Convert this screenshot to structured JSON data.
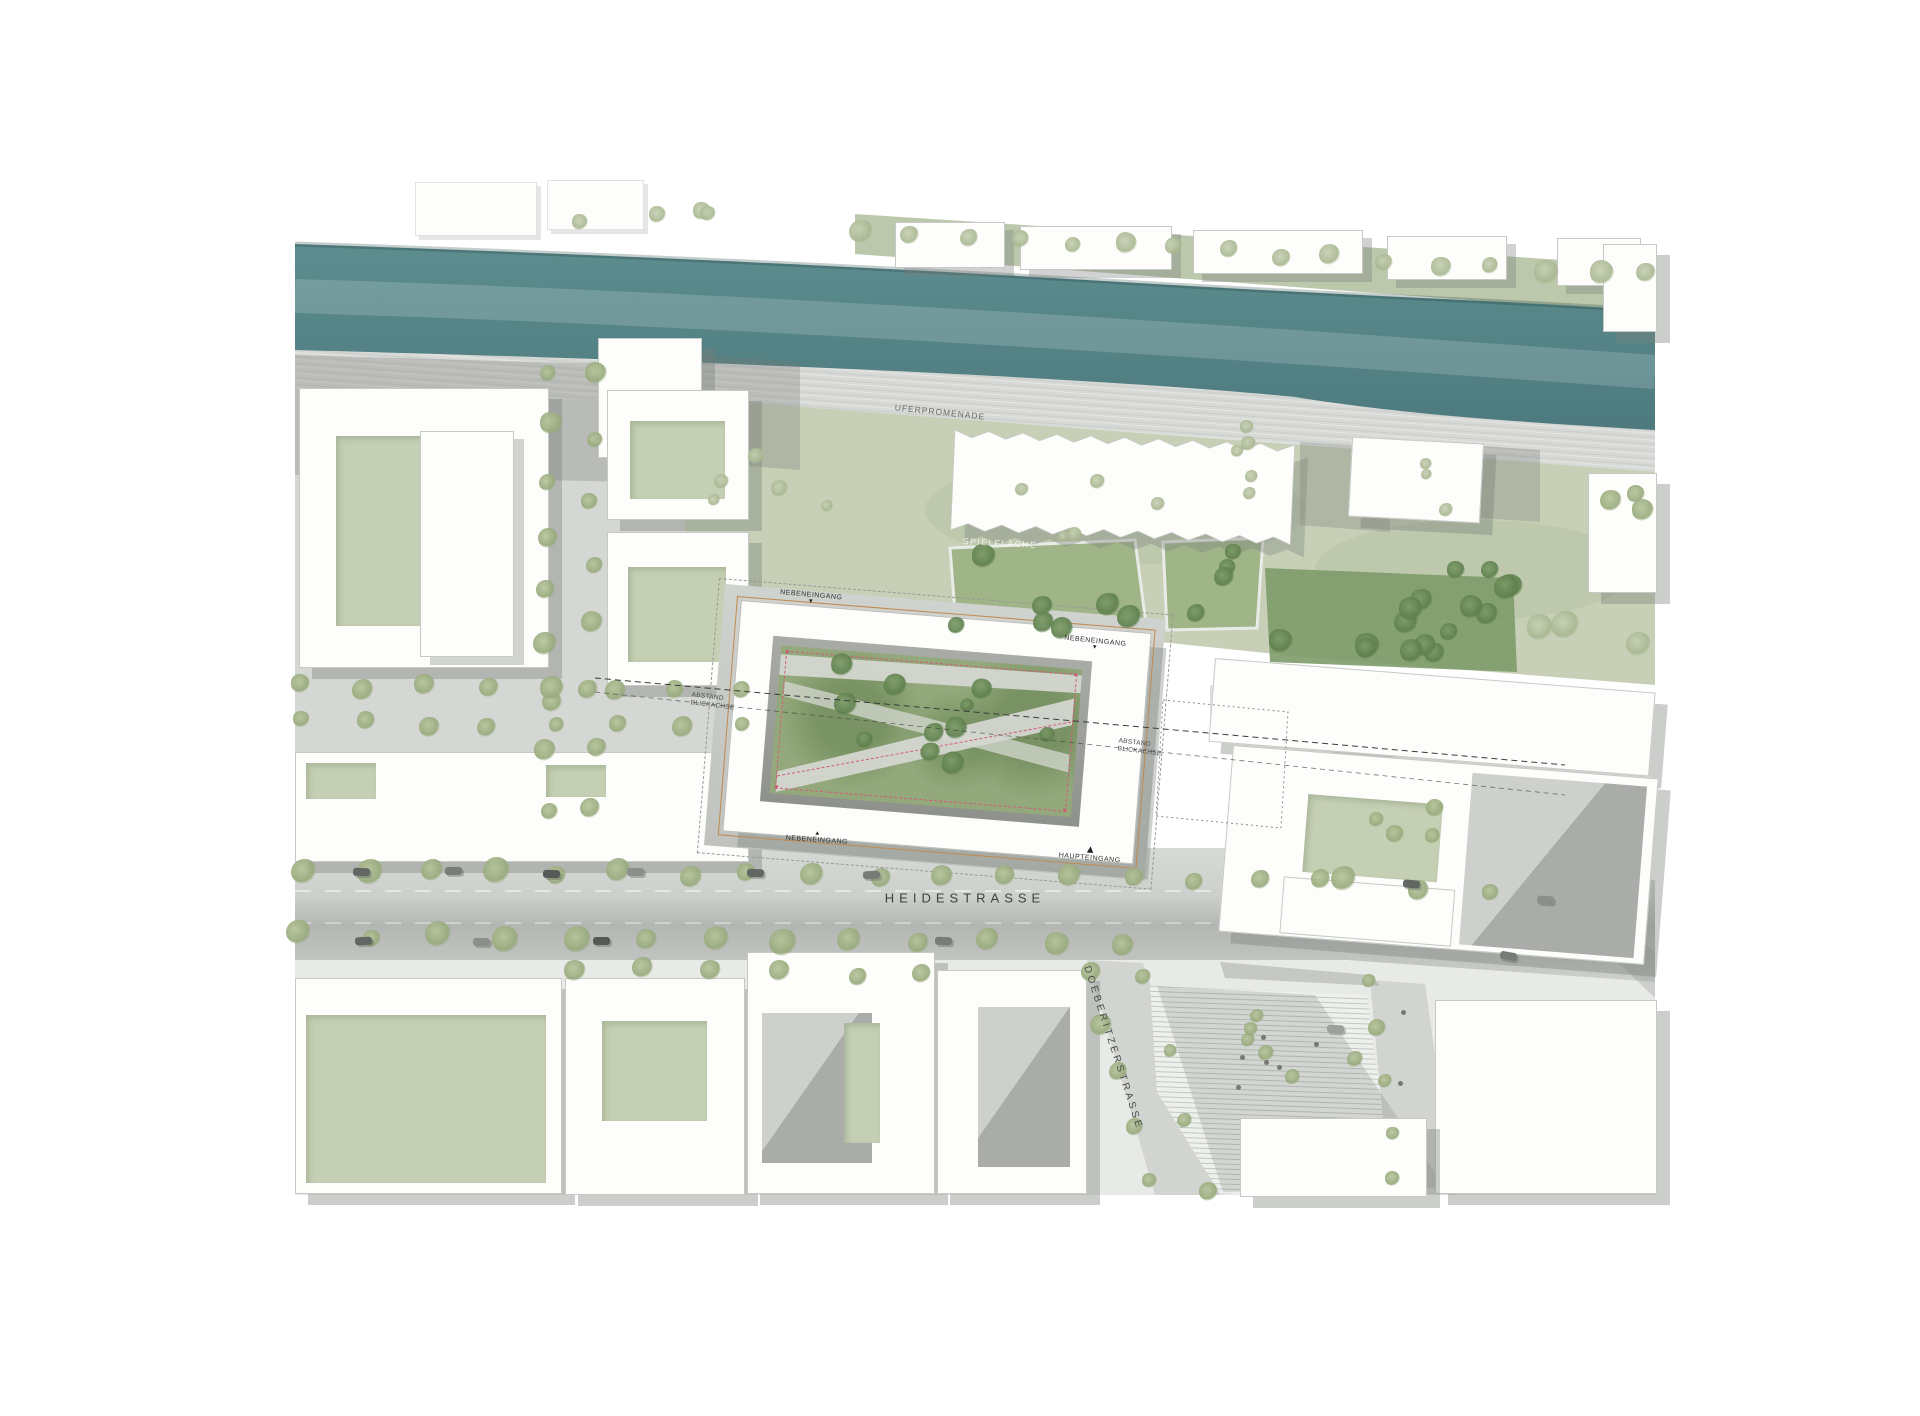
{
  "labels": {
    "heidestrasse": "HEIDESTRASSE",
    "doeberitzerstrasse": "DOEBERITZERSTRASSE",
    "uferpromenade": "UFERPROMENADE",
    "spielflaeche": "SPIELFLÄCHE",
    "nebeneingang": "NEBENEINGANG",
    "haupteingang": "HAUPTEINGANG",
    "abstand": "ABSTAND",
    "blickachse": "BLICKACHSE"
  },
  "icons": {
    "arrow_down": "▼",
    "arrow_up": "▲"
  },
  "colors": {
    "river": "#4d7a7e",
    "river_light": "#5d8d8f",
    "lawn": "#c7d0b7",
    "bank": "#bcc8ab",
    "grove": "#7d9b69",
    "street": "#d6d8d5",
    "street_dark": "#b4b7b4",
    "shadow": "#767b76",
    "outline_orange": "#c08a50",
    "measure_pink": "#d25c78"
  }
}
